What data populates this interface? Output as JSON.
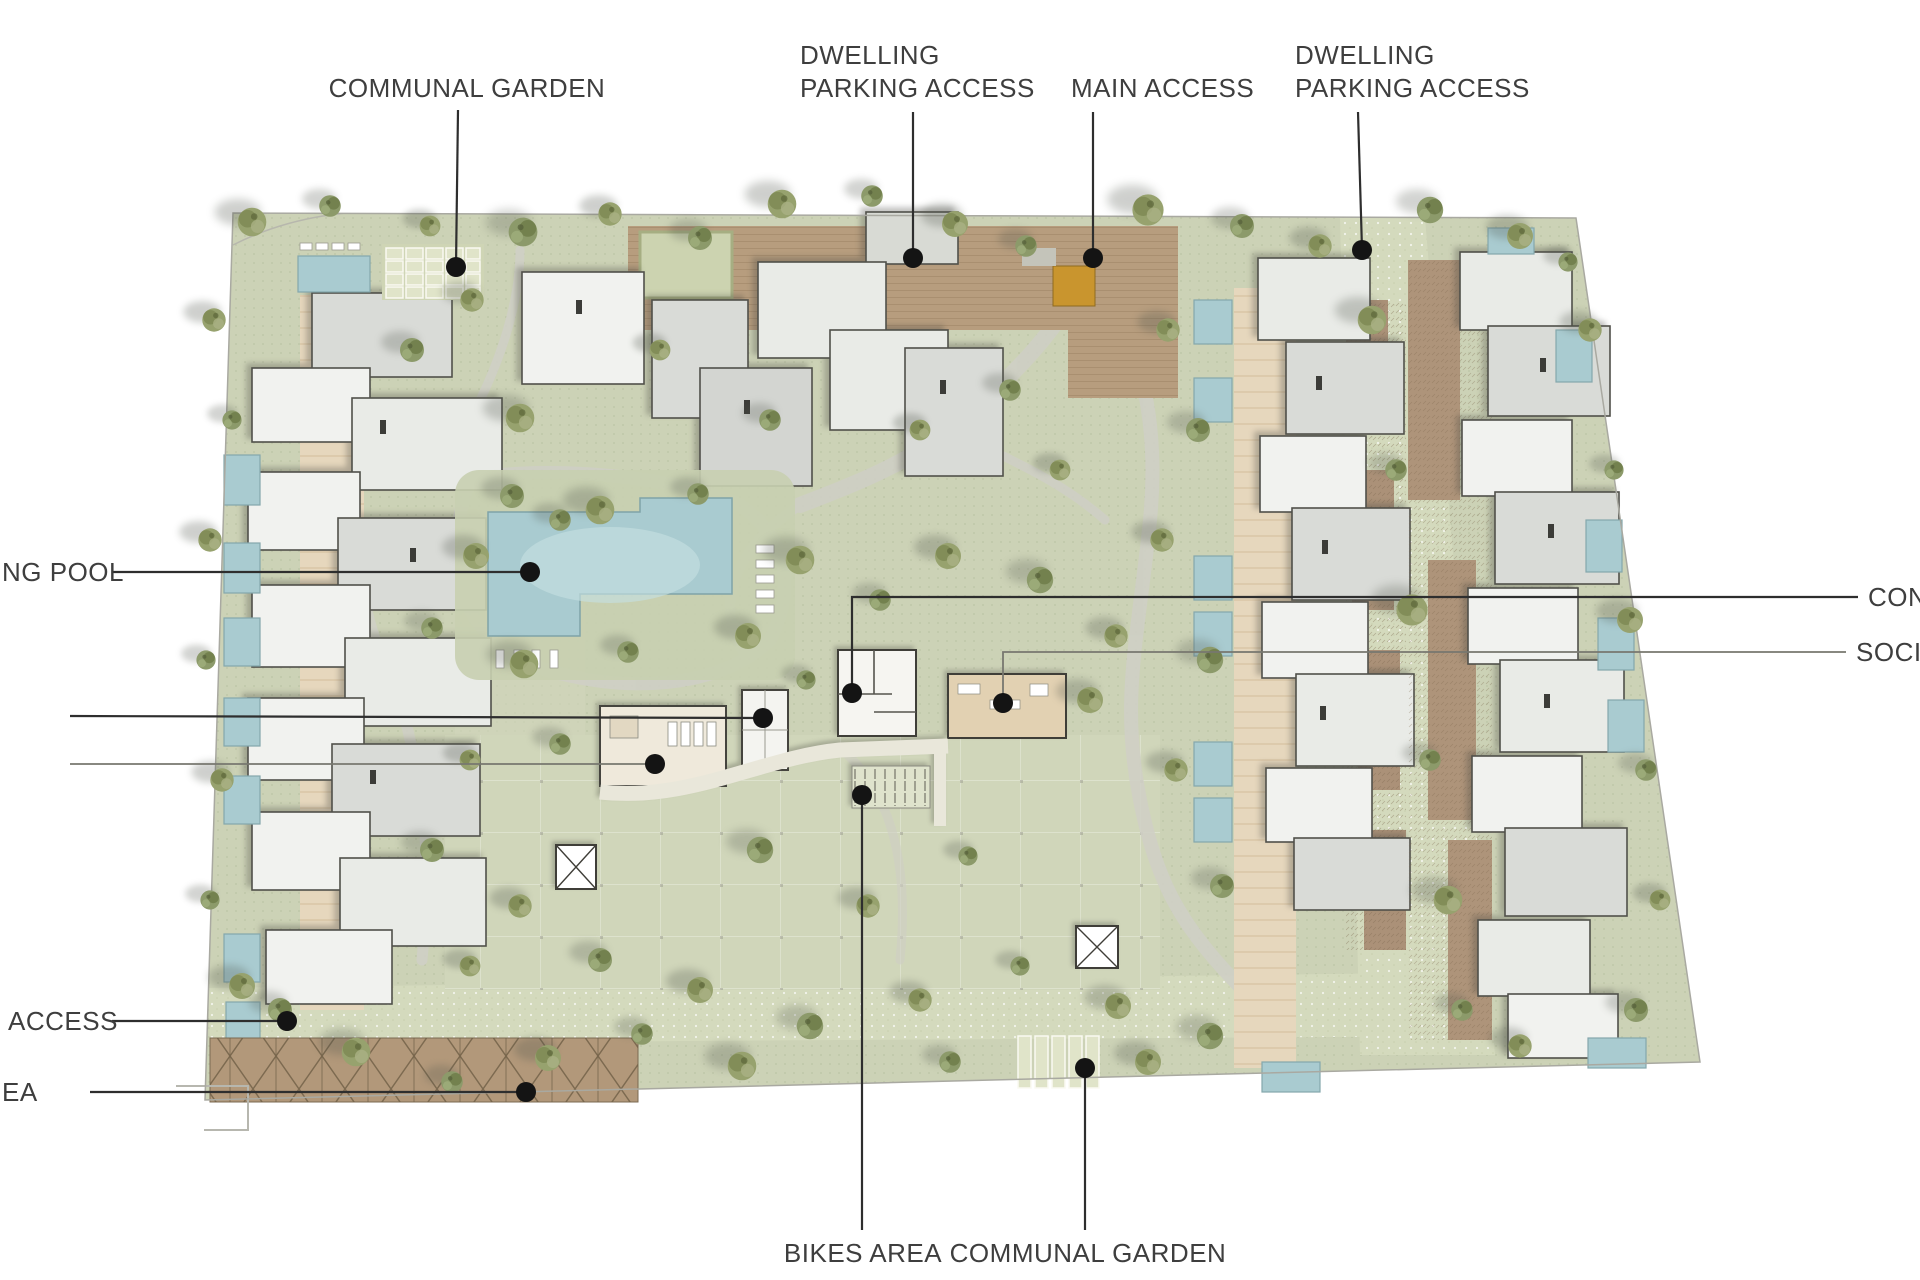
{
  "document": {
    "type": "architectural-site-plan",
    "background": "#ffffff"
  },
  "colors": {
    "label_text": "#3e3e3e",
    "leader_line": "#2e2e2e",
    "leader_line_light": "#77776f",
    "leader_dot": "#141414",
    "ground": "#ccd2b6",
    "paver_road": "#d4dabd",
    "path_gray": "#cfcfc5",
    "spine_path_tan": "#e6d7bd",
    "deck_brown": "#b79d7e",
    "pergola_brown": "#b2987a",
    "roof_white": "#f1f2ef",
    "roof_light": "#e9ebe7",
    "roof_mid": "#d9dbd7",
    "roof_outline": "#50504a",
    "pool_water": "#a9cbd0",
    "pool_light": "#c5dee1",
    "tree_olive": "#97a26e",
    "tree_dark": "#6f7c49",
    "planter_green": "#e0e4c9",
    "gate_orange": "#c9952e",
    "social_tan": "#e2d1b2"
  },
  "callouts": [
    {
      "name": "communal-garden-top",
      "lines": [
        "COMMUNAL GARDEN"
      ],
      "x": 467,
      "y": 97,
      "anchor": "middle",
      "leader": [
        [
          458,
          110
        ],
        [
          456,
          266
        ]
      ],
      "dot": [
        456,
        267
      ],
      "stroke": "dark"
    },
    {
      "name": "dwelling-parking-access-left",
      "lines": [
        "DWELLING",
        "PARKING ACCESS"
      ],
      "x": 800,
      "y": 64,
      "anchor": "start",
      "line_height": 33,
      "leader": [
        [
          913,
          112
        ],
        [
          913,
          257
        ]
      ],
      "dot": [
        913,
        258
      ],
      "stroke": "dark"
    },
    {
      "name": "main-access",
      "lines": [
        "MAIN ACCESS"
      ],
      "x": 1071,
      "y": 97,
      "anchor": "start",
      "leader": [
        [
          1093,
          112
        ],
        [
          1093,
          257
        ]
      ],
      "dot": [
        1093,
        258
      ],
      "stroke": "dark"
    },
    {
      "name": "dwelling-parking-access-right",
      "lines": [
        "DWELLING",
        "PARKING ACCESS"
      ],
      "x": 1295,
      "y": 64,
      "anchor": "start",
      "line_height": 33,
      "leader": [
        [
          1358,
          112
        ],
        [
          1362,
          249
        ]
      ],
      "dot": [
        1362,
        250
      ],
      "stroke": "dark"
    },
    {
      "name": "swimming-pool",
      "lines": [
        "NG POOL"
      ],
      "x": 2,
      "y": 581,
      "anchor": "start",
      "leader": [
        [
          112,
          572
        ],
        [
          530,
          572
        ]
      ],
      "dot": [
        530,
        572
      ],
      "stroke": "dark"
    },
    {
      "name": "facility-leader-upper",
      "lines": [],
      "x": 0,
      "y": 0,
      "anchor": "start",
      "leader": [
        [
          70,
          716
        ],
        [
          762,
          718
        ]
      ],
      "dot": [
        763,
        718
      ],
      "stroke": "dark"
    },
    {
      "name": "facility-leader-lower",
      "lines": [],
      "x": 0,
      "y": 0,
      "anchor": "start",
      "leader": [
        [
          70,
          764
        ],
        [
          654,
          764
        ]
      ],
      "dot": [
        655,
        764
      ],
      "stroke": "light"
    },
    {
      "name": "concierge",
      "lines": [
        "CON"
      ],
      "x": 1868,
      "y": 606,
      "anchor": "start",
      "leader": [
        [
          1858,
          597
        ],
        [
          852,
          597
        ],
        [
          852,
          692
        ]
      ],
      "dot": [
        852,
        693
      ],
      "stroke": "dark"
    },
    {
      "name": "social",
      "lines": [
        "SOCIA"
      ],
      "x": 1856,
      "y": 661,
      "anchor": "start",
      "leader": [
        [
          1846,
          652
        ],
        [
          1003,
          652
        ],
        [
          1003,
          702
        ]
      ],
      "dot": [
        1003,
        703
      ],
      "stroke": "light"
    },
    {
      "name": "access-bottom-left",
      "lines": [
        "ACCESS"
      ],
      "x": 8,
      "y": 1030,
      "anchor": "start",
      "leader": [
        [
          112,
          1021
        ],
        [
          286,
          1021
        ]
      ],
      "dot": [
        287,
        1021
      ],
      "stroke": "dark"
    },
    {
      "name": "area-bottom-left",
      "lines": [
        "EA"
      ],
      "x": 2,
      "y": 1101,
      "anchor": "start",
      "leader": [
        [
          90,
          1092
        ],
        [
          525,
          1092
        ]
      ],
      "dot": [
        526,
        1092
      ],
      "stroke": "dark"
    },
    {
      "name": "bikes-area",
      "lines": [
        "BIKES AREA"
      ],
      "x": 863,
      "y": 1262,
      "anchor": "middle",
      "leader": [
        [
          862,
          1230
        ],
        [
          862,
          796
        ]
      ],
      "dot": [
        862,
        795
      ],
      "stroke": "dark"
    },
    {
      "name": "communal-garden-bottom",
      "lines": [
        "COMMUNAL GARDEN"
      ],
      "x": 1088,
      "y": 1262,
      "anchor": "middle",
      "leader": [
        [
          1085,
          1230
        ],
        [
          1085,
          1069
        ]
      ],
      "dot": [
        1085,
        1068
      ],
      "stroke": "dark"
    }
  ],
  "label_style": {
    "font_size": 26,
    "line_height": 33
  }
}
